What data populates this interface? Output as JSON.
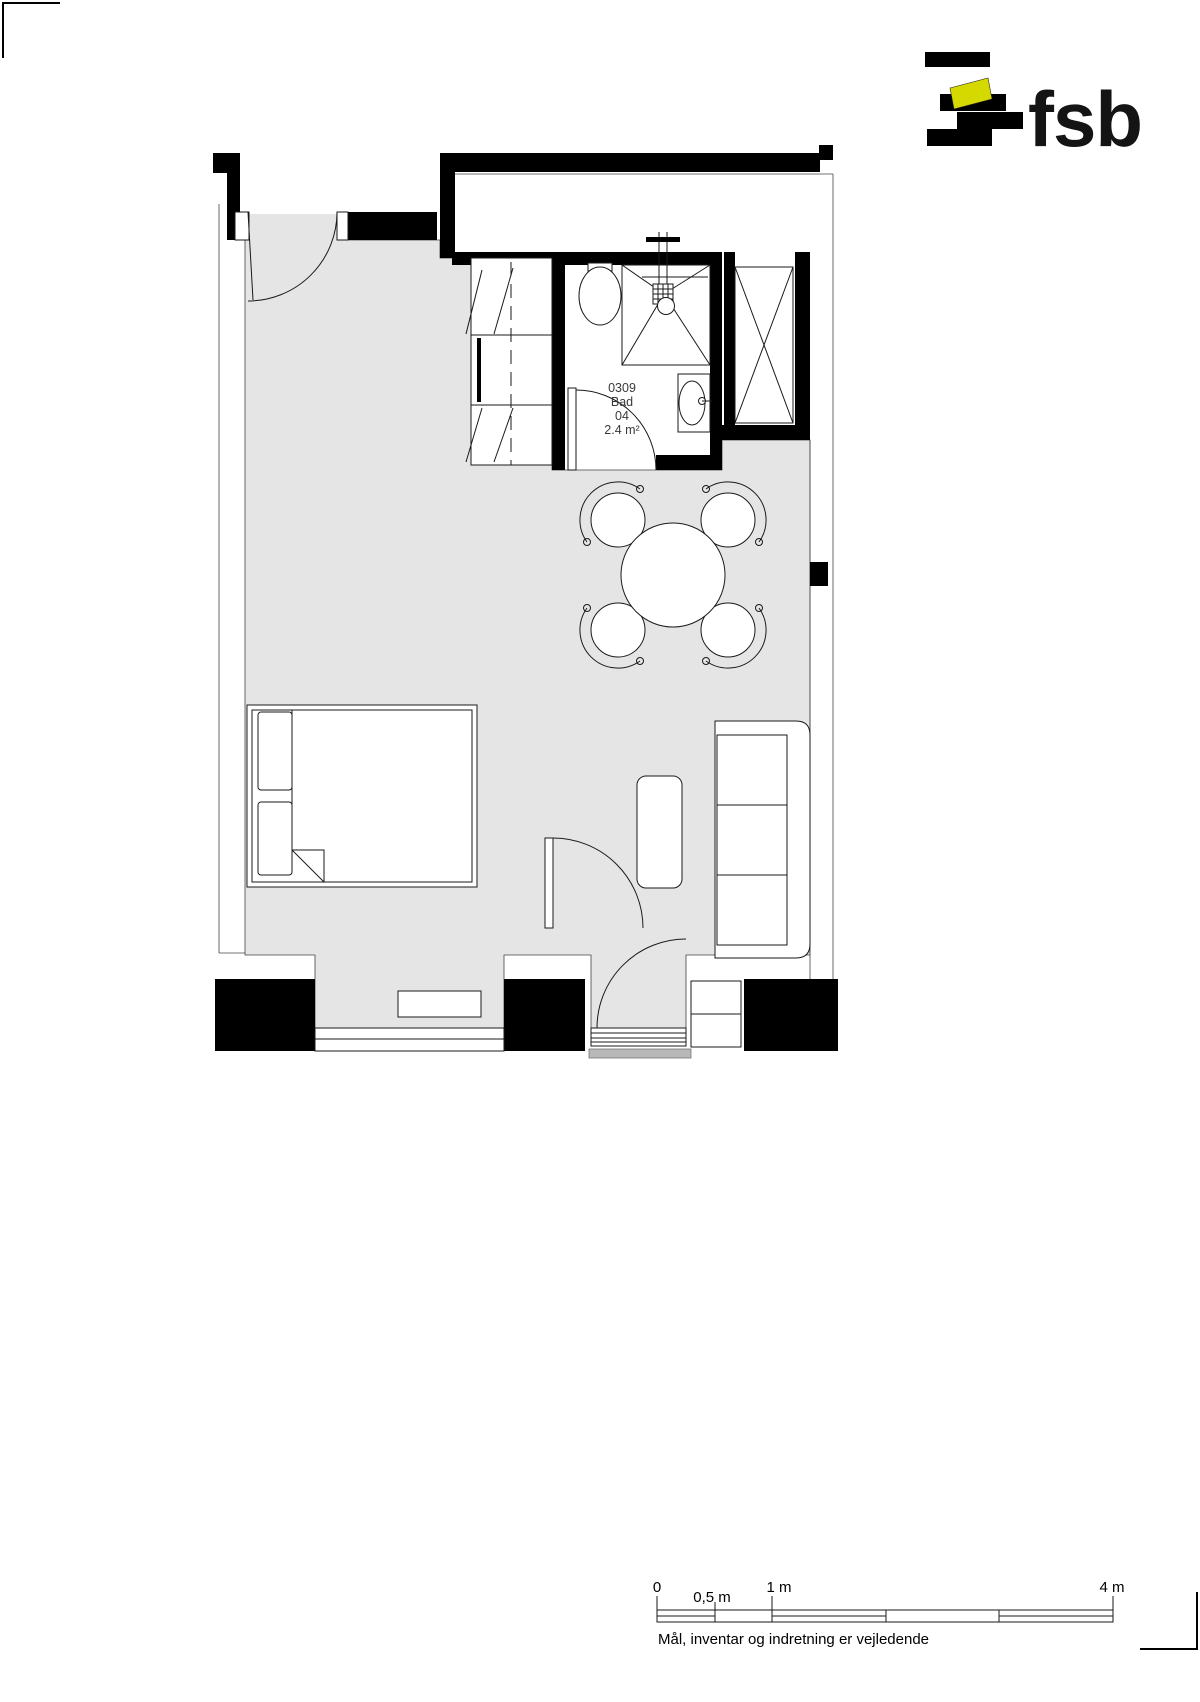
{
  "page": {
    "background": "#ffffff"
  },
  "logo": {
    "text": "fsb",
    "bar_color": "#0d0d0d",
    "accent_color": "#d6d900"
  },
  "plan": {
    "floor_color": "#e5e5e5",
    "wall_color": "#000000",
    "room_label": {
      "l1": "0309",
      "l2": "Bad",
      "l3": "04",
      "l4": "2.4 m²"
    }
  },
  "scale": {
    "t0": "0",
    "t05": "0,5 m",
    "t1": "1 m",
    "t4": "4 m",
    "caption": "Mål, inventar og indretning er vejledende"
  }
}
